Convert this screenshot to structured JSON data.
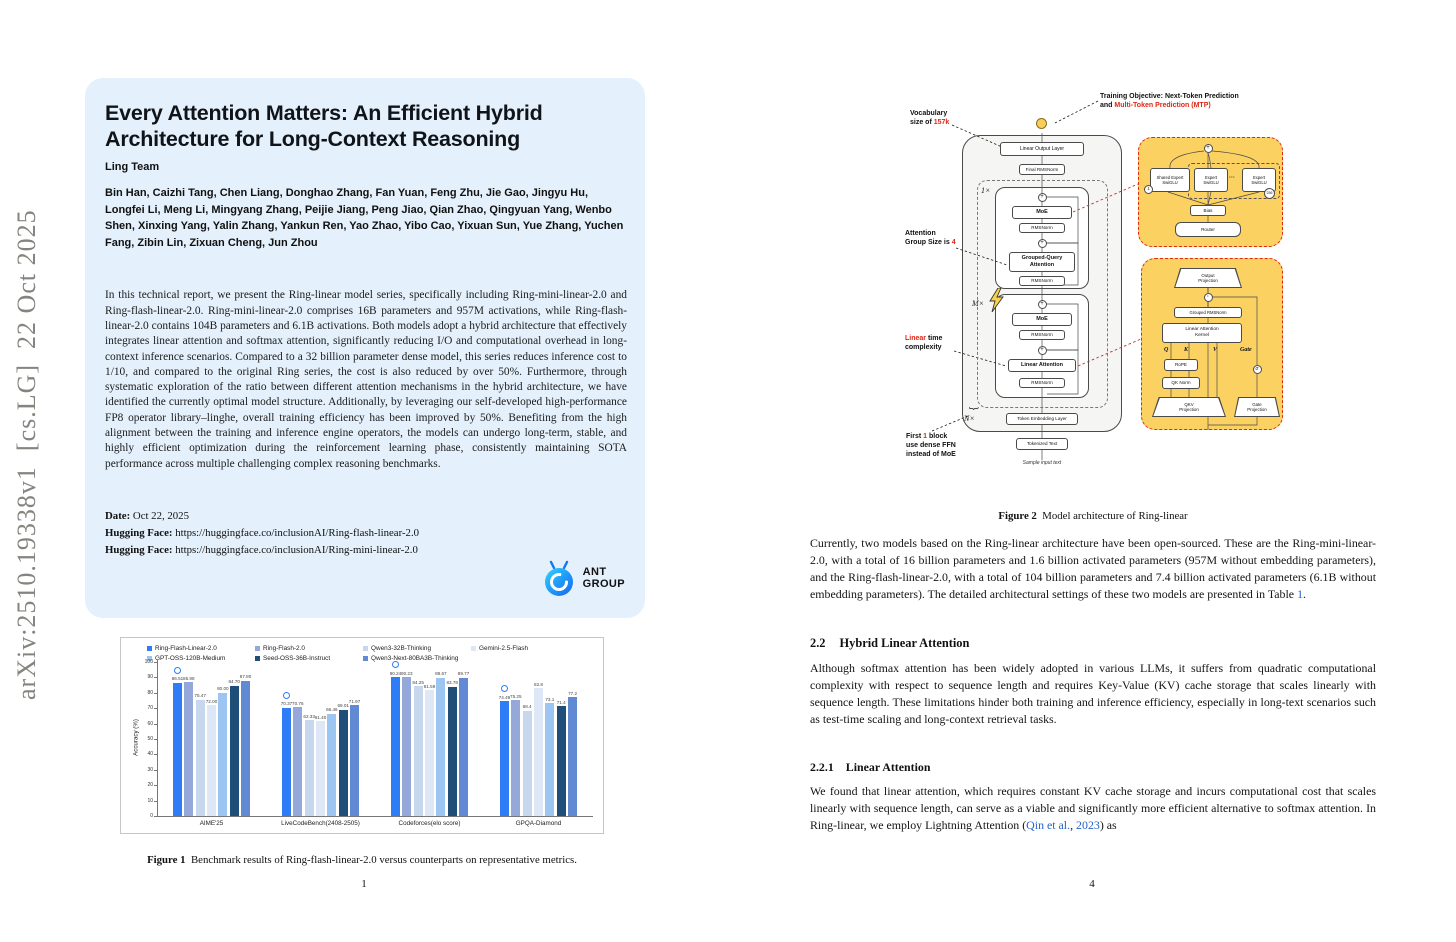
{
  "arxiv_sidebar": "arXiv:2510.19338v1  [cs.LG]  22 Oct 2025",
  "left_page": {
    "title": "Every Attention Matters: An Efficient Hybrid Architecture for Long-Context Reasoning",
    "team": "Ling Team",
    "authors": "Bin Han, Caizhi Tang, Chen Liang, Donghao Zhang, Fan Yuan, Feng Zhu, Jie Gao, Jingyu Hu, Longfei Li, Meng Li, Mingyang Zhang, Peijie Jiang, Peng Jiao, Qian Zhao, Qingyuan Yang, Wenbo Shen, Xinxing Yang, Yalin Zhang, Yankun Ren, Yao Zhao, Yibo Cao, Yixuan Sun, Yue Zhang, Yuchen Fang, Zibin Lin, Zixuan Cheng, Jun Zhou",
    "abstract": "In this technical report, we present the Ring-linear model series, specifically including Ring-mini-linear-2.0 and Ring-flash-linear-2.0. Ring-mini-linear-2.0 comprises 16B parameters and 957M activations, while Ring-flash-linear-2.0 contains 104B parameters and 6.1B activations. Both models adopt a hybrid architecture that effectively integrates linear attention and softmax attention, significantly reducing I/O and computational overhead in long-context inference scenarios. Compared to a 32 billion parameter dense model, this series reduces inference cost to 1/10, and compared to the original Ring series, the cost is also reduced by over 50%. Furthermore, through systematic exploration of the ratio between different attention mechanisms in the hybrid architecture, we have identified the currently optimal model structure. Additionally, by leveraging our self-developed high-performance FP8 operator library–linghe, overall training efficiency has been improved by 50%. Benefiting from the high alignment between the training and inference engine operators, the models can undergo long-term, stable, and highly efficient optimization during the reinforcement learning phase, consistently maintaining SOTA performance across multiple challenging complex reasoning benchmarks.",
    "date_label": "Date:",
    "date_value": "Oct 22, 2025",
    "hf_label": "Hugging Face:",
    "hf_link_1": "https://huggingface.co/inclusionAI/Ring-flash-linear-2.0",
    "hf_link_2": "https://huggingface.co/inclusionAI/Ring-mini-linear-2.0",
    "logo_text_1": "ANT",
    "logo_text_2": "GROUP",
    "figure1_caption_label": "Figure 1",
    "figure1_caption": "Benchmark results of Ring-flash-linear-2.0 versus counterparts on representative metrics.",
    "page_number": "1"
  },
  "chart_data": {
    "type": "bar",
    "title": "",
    "xlabel": "",
    "ylabel": "Accuracy (%)",
    "ylim": [
      0,
      100
    ],
    "yticks": [
      0,
      10,
      20,
      30,
      40,
      50,
      60,
      70,
      80,
      90,
      100
    ],
    "grid": false,
    "legend_position": "top",
    "categories": [
      "AIME'25",
      "LiveCodeBench(2408-2505)",
      "Codeforces(elo score)",
      "GPQA-Diamond"
    ],
    "series": [
      {
        "name": "Ring-Flash-Linear-2.0",
        "color": "#2e7df6",
        "values": [
          86.51,
          70.37,
          90.24,
          74.49
        ],
        "labels": [
          "86.51",
          "70.37",
          "90.24",
          "74.49"
        ]
      },
      {
        "name": "Ring-Flash-2.0",
        "color": "#94a9d9",
        "values": [
          86.98,
          70.76,
          90.23,
          75.25
        ],
        "labels": [
          "86.98",
          "70.76",
          "90.23",
          "75.25"
        ]
      },
      {
        "name": "Qwen3-32B-Thinking",
        "color": "#c6d7ee",
        "values": [
          75.47,
          62.33,
          84.25,
          68.4
        ],
        "labels": [
          "75.47",
          "62.33",
          "84.25",
          "68.4"
        ]
      },
      {
        "name": "Gemini-2.5-Flash",
        "color": "#dde7f5",
        "values": [
          72.0,
          61.4,
          81.59,
          82.8
        ],
        "labels": [
          "72.00",
          "61.40",
          "81.59",
          "82.8"
        ]
      },
      {
        "name": "GPT-OSS-120B-Medium",
        "color": "#9cc5f1",
        "values": [
          80.0,
          66.46,
          89.67,
          73.1
        ],
        "labels": [
          "80.00",
          "66.46",
          "89.67",
          "73.1"
        ]
      },
      {
        "name": "Seed-OSS-36B-Instruct",
        "color": "#1f4e79",
        "values": [
          84.7,
          69.01,
          83.78,
          71.4
        ],
        "labels": [
          "84.70",
          "69.01",
          "83.78",
          "71.4"
        ]
      },
      {
        "name": "Qwen3-Next-80BA3B-Thinking",
        "color": "#6189d4",
        "values": [
          87.8,
          71.97,
          89.77,
          77.2
        ],
        "labels": [
          "87.80",
          "71.97",
          "89.77",
          "77.2"
        ]
      }
    ]
  },
  "right_page": {
    "figure2": {
      "training_objective_pre": "Training Objective: Next-Token Prediction\nand ",
      "training_objective_red": "Multi-Token Prediction (MTP)",
      "vocab_pre": "Vocabulary\nsize of ",
      "vocab_red": "157k",
      "attn_group_pre": "Attention\nGroup Size is ",
      "attn_group_red": "4",
      "linear_red": "Linear",
      "linear_post": " time\ncomplexity",
      "first_pre": "First ",
      "first_red": "1",
      "first_post": " block\nuse dense FFN\ninstead of MoE",
      "mult_1": "1×",
      "mult_m": "M×",
      "mult_n": "N×",
      "linear_output_layer": "Linear Output Layer",
      "final_rmsnorm": "Final RMSNorm",
      "moe": "MoE",
      "rmsnorm": "RMSNorm",
      "gqa": "Grouped-Query\nAttention",
      "linear_attention": "Linear Attention",
      "token_embedding_layer": "Token Embedding Layer",
      "tokenized_text": "Tokenized Text",
      "sample_input_text": "Sample input text",
      "plus": "+",
      "dot": "·",
      "sigma": "σ",
      "moe_panel": {
        "shared_expert": "Shared Expert\nSwiGLU",
        "expert": "Expert\nSwiGLU",
        "dots": "···",
        "c1": "1",
        "c256": "256",
        "bias": "Bias",
        "router": "Router"
      },
      "la_panel": {
        "output_projection": "Output\nProjection",
        "grouped_rmsnorm": "Grouped RMSNorm",
        "kernel": "Linear Attention\nKernel",
        "q": "Q",
        "k": "K",
        "v": "V",
        "gate": "Gate",
        "rope": "RoPE",
        "qk_norm": "QK Norm",
        "qkv_projection": "QKV\nProjection",
        "gate_projection": "Gate\nProjection"
      }
    },
    "figure2_caption_label": "Figure 2",
    "figure2_caption": "Model architecture of Ring-linear",
    "para1_pre": "Currently, two models based on the Ring-linear architecture have been open-sourced. These are the Ring-mini-linear-2.0, with a total of 16 billion parameters and 1.6 billion activated parameters (957M without embedding parameters), and the Ring-flash-linear-2.0, with a total of 104 billion parameters and 7.4 billion activated parameters (6.1B without embedding parameters). The detailed architectural settings of these two models are presented in Table ",
    "para1_link": "1",
    "para1_post": ".",
    "sec22_num": "2.2",
    "sec22_title": "Hybrid Linear Attention",
    "para2": "Although softmax attention has been widely adopted in various LLMs, it suffers from quadratic computational complexity with respect to sequence length and requires Key-Value (KV) cache storage that scales linearly with sequence length.  These limitations hinder both training and inference efficiency, especially in long-text scenarios such as test-time scaling and long-context retrieval tasks.",
    "sec221_num": "2.2.1",
    "sec221_title": "Linear Attention",
    "para3_pre": "We found that linear attention, which requires constant KV cache storage and incurs computational cost that scales linearly with sequence length, can serve as a viable and significantly more efficient alternative to softmax attention. In Ring-linear, we employ Lightning Attention (",
    "para3_link1": "Qin et al.",
    "para3_mid": ", ",
    "para3_link2": "2023",
    "para3_post": ") as",
    "page_number": "4"
  }
}
